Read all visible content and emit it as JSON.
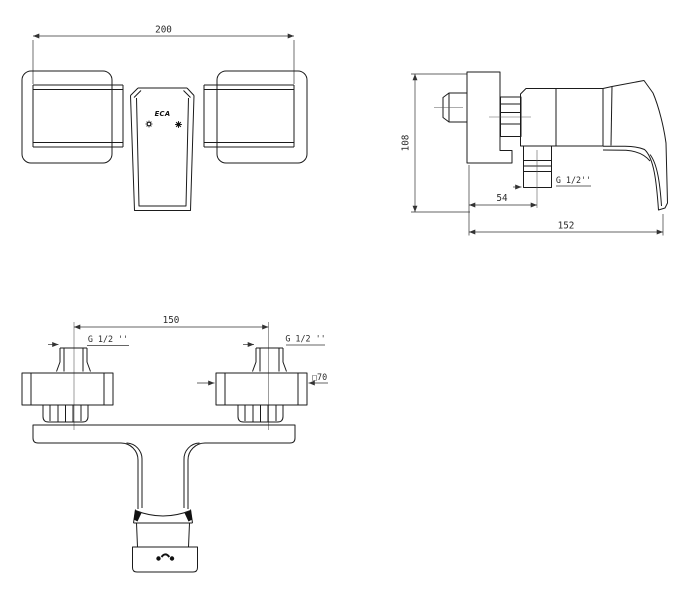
{
  "colors": {
    "background": "#ffffff",
    "line": "#1b1b1b",
    "dimension": "#333333"
  },
  "brand": {
    "logo": "ECA"
  },
  "views": {
    "front": {
      "width_dim": "200"
    },
    "side": {
      "height_dim": "108",
      "wall_to_outlet_dim": "54",
      "depth_dim": "152",
      "outlet_thread": "G 1/2''"
    },
    "top": {
      "centers_dim": "150",
      "thread_left": "G 1/2 ''",
      "thread_right": "G 1/2 ''",
      "escutcheon_label": "□70"
    }
  },
  "icons": {
    "cold-indicator-icon": "spoked-dial-outline",
    "hot-indicator-icon": "spoked-dial-filled",
    "brand-mark-knob-icon": "two-dots-with-arch"
  }
}
